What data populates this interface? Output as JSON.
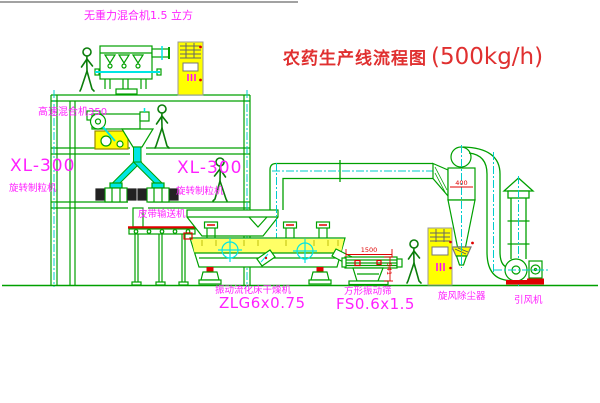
{
  "diagram": {
    "title_zh": "农药生产线流程图",
    "title_capacity": "(500kg/h)",
    "labels": {
      "gravity_mixer": "无重力混合机1.5 立方",
      "highspeed_mixer": "高速混合机350",
      "granulator_left_model": "XL-300",
      "granulator_left_name": "旋转制粒机",
      "granulator_right_model": "XL-300",
      "granulator_right_name": "旋转制粒机",
      "belt_conveyor": "皮带输送机",
      "dryer_name": "振动流化床干燥机",
      "dryer_model": "ZLG6x0.75",
      "screen_name": "方形振动筛",
      "screen_model": "FS0.6x1.5",
      "cyclone": "旋风除尘器",
      "fan": "引风机"
    },
    "dimensions": {
      "screen_length": "1500",
      "screen_height": "541",
      "cyclone_width": "400"
    },
    "colors": {
      "line_green": "#00a000",
      "centerline_cyan": "#00cccc",
      "chute_cyan": "#00e5e5",
      "label_magenta": "#ff20ff",
      "title_red": "#e03030",
      "dimension_red": "#e00000",
      "cabinet_yellow": "#ffff00"
    }
  }
}
